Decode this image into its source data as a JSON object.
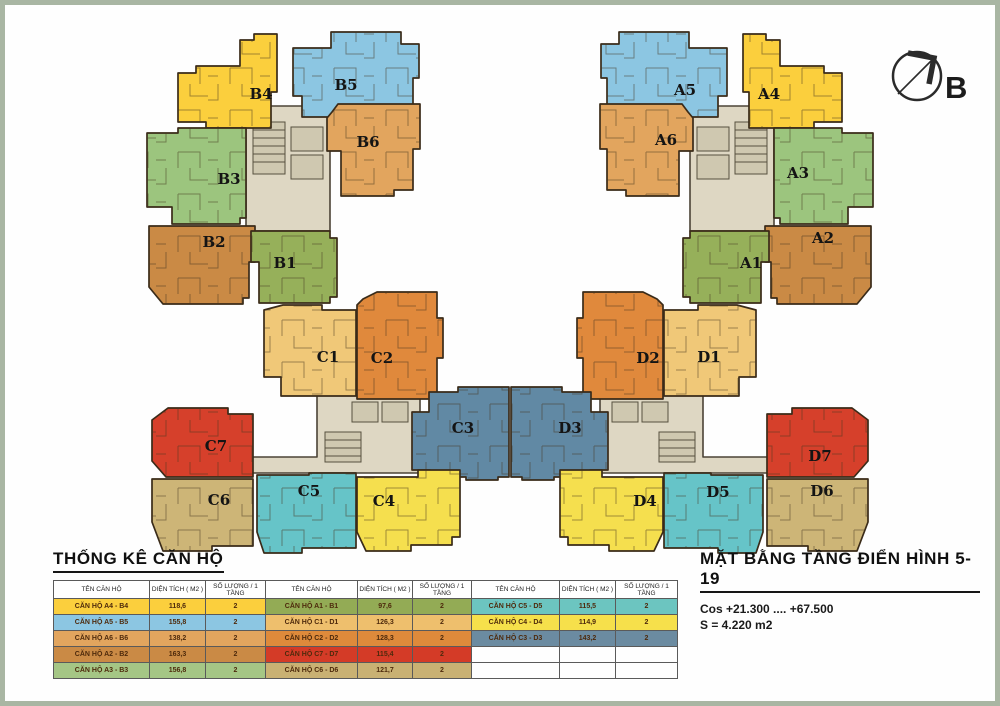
{
  "page": {
    "border_color": "#a9b6a3",
    "background": "#fefefe"
  },
  "compass": {
    "label": "B"
  },
  "plan": {
    "core_color": "#ded7c3"
  },
  "units": {
    "B4": {
      "label": "B4",
      "color": "#fbcf3d"
    },
    "B5": {
      "label": "B5",
      "color": "#8cc6e2"
    },
    "B6": {
      "label": "B6",
      "color": "#e2a55e"
    },
    "B3": {
      "label": "B3",
      "color": "#9cc57e"
    },
    "B2": {
      "label": "B2",
      "color": "#ca8a45"
    },
    "B1": {
      "label": "B1",
      "color": "#96b05a"
    },
    "A4": {
      "label": "A4",
      "color": "#fbcf3d"
    },
    "A5": {
      "label": "A5",
      "color": "#8cc6e2"
    },
    "A6": {
      "label": "A6",
      "color": "#e2a55e"
    },
    "A3": {
      "label": "A3",
      "color": "#9cc57e"
    },
    "A2": {
      "label": "A2",
      "color": "#ca8a45"
    },
    "A1": {
      "label": "A1",
      "color": "#96b05a"
    },
    "C1": {
      "label": "C1",
      "color": "#f0c878"
    },
    "C2": {
      "label": "C2",
      "color": "#e0893c"
    },
    "C3": {
      "label": "C3",
      "color": "#6189a4"
    },
    "C4": {
      "label": "C4",
      "color": "#f5df4e"
    },
    "C5": {
      "label": "C5",
      "color": "#66c4c8"
    },
    "C6": {
      "label": "C6",
      "color": "#cdb577"
    },
    "C7": {
      "label": "C7",
      "color": "#d6402b"
    },
    "D1": {
      "label": "D1",
      "color": "#f0c878"
    },
    "D2": {
      "label": "D2",
      "color": "#e0893c"
    },
    "D3": {
      "label": "D3",
      "color": "#6189a4"
    },
    "D4": {
      "label": "D4",
      "color": "#f5df4e"
    },
    "D5": {
      "label": "D5",
      "color": "#66c4c8"
    },
    "D6": {
      "label": "D6",
      "color": "#cdb577"
    },
    "D7": {
      "label": "D7",
      "color": "#d6402b"
    }
  },
  "stats": {
    "title": "THỐNG KÊ CĂN HỘ",
    "headers": {
      "name": "TÊN CĂN HỘ",
      "area": "DIỆN TÍCH ( M2 )",
      "qty": "SỐ LƯỢNG / 1 TẦNG"
    },
    "rows_g1": [
      {
        "name": "CĂN HỘ A4 - B4",
        "area": "118,6",
        "qty": "2",
        "color": "#fbcf3d"
      },
      {
        "name": "CĂN HỘ A5 - B5",
        "area": "155,8",
        "qty": "2",
        "color": "#8cc6e2"
      },
      {
        "name": "CĂN HỘ A6 - B6",
        "area": "138,2",
        "qty": "2",
        "color": "#e2a55e"
      },
      {
        "name": "CĂN HỘ A2 - B2",
        "area": "163,3",
        "qty": "2",
        "color": "#ca8a45"
      },
      {
        "name": "CĂN HỘ A3 - B3",
        "area": "156,8",
        "qty": "2",
        "color": "#a5c685"
      }
    ],
    "rows_g2": [
      {
        "name": "CĂN HỘ A1 - B1",
        "area": "97,6",
        "qty": "2",
        "color": "#93ab55"
      },
      {
        "name": "CĂN HỘ C1 - D1",
        "area": "126,3",
        "qty": "2",
        "color": "#eebf6d"
      },
      {
        "name": "CĂN HỘ C2 - D2",
        "area": "128,3",
        "qty": "2",
        "color": "#de8a3b"
      },
      {
        "name": "CĂN HỘ C7 - D7",
        "area": "115,4",
        "qty": "2",
        "color": "#d43b27"
      },
      {
        "name": "CĂN HỘ C6 - D6",
        "area": "121,7",
        "qty": "2",
        "color": "#c9b173"
      }
    ],
    "rows_g3": [
      {
        "name": "CĂN HỘ C5 - D5",
        "area": "115,5",
        "qty": "2",
        "color": "#6cc5c0"
      },
      {
        "name": "CĂN HỘ C4 - D4",
        "area": "114,9",
        "qty": "2",
        "color": "#f6e04b"
      },
      {
        "name": "CĂN HỘ C3 - D3",
        "area": "143,2",
        "qty": "2",
        "color": "#6b8ba1"
      }
    ]
  },
  "legend": {
    "title": "MẶT BẰNG TẦNG ĐIỂN HÌNH 5-19",
    "cos": "Cos +21.300 .... +67.500",
    "area": "S = 4.220 m2"
  }
}
